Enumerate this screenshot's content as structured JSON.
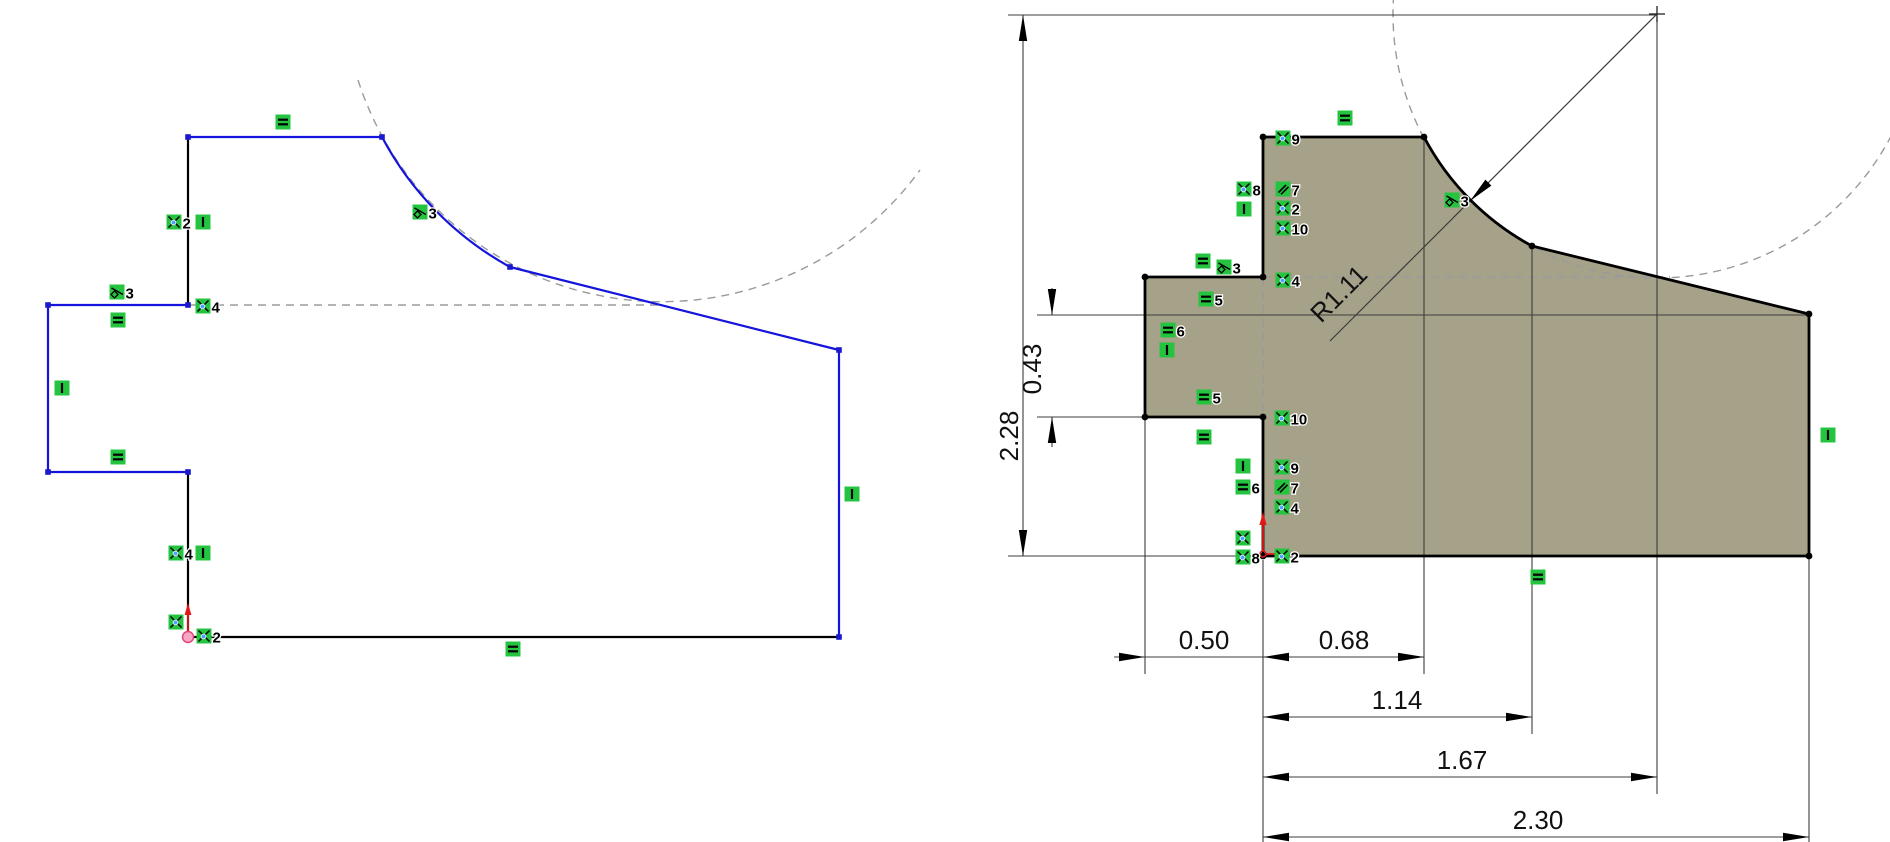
{
  "canvas": {
    "width": 1890,
    "height": 842,
    "background": "#ffffff"
  },
  "palette": {
    "edge_blue": "#1414dd",
    "edge_black": "#000000",
    "part_fill": "#a6a289",
    "relation_green": "#25c440",
    "dash_gray": "#9a9a9a",
    "dim_line": "#3c3c3c",
    "dim_text": "#111111",
    "origin_red": "#e01818",
    "origin_pink": "#f5a7c3",
    "vertex_blue": "#1a1acc",
    "vertex_black": "#000000",
    "coincident_dot": "#4da2ff"
  },
  "left_sketch": {
    "name": "under-defined-profile",
    "edges": [
      {
        "x1": 188,
        "y1": 137,
        "x2": 382,
        "y2": 137,
        "color": "blue"
      },
      {
        "type": "arc",
        "d": "M382 137 A319 319 0 0 0 510 267",
        "color": "blue"
      },
      {
        "x1": 510,
        "y1": 267,
        "x2": 839,
        "y2": 350,
        "color": "blue"
      },
      {
        "x1": 839,
        "y1": 350,
        "x2": 839,
        "y2": 637,
        "color": "blue"
      },
      {
        "x1": 839,
        "y1": 637,
        "x2": 188,
        "y2": 637,
        "color": "black"
      },
      {
        "x1": 188,
        "y1": 637,
        "x2": 188,
        "y2": 472,
        "color": "black"
      },
      {
        "x1": 188,
        "y1": 472,
        "x2": 48,
        "y2": 472,
        "color": "blue"
      },
      {
        "x1": 48,
        "y1": 472,
        "x2": 48,
        "y2": 305,
        "color": "blue"
      },
      {
        "x1": 48,
        "y1": 305,
        "x2": 188,
        "y2": 305,
        "color": "blue"
      },
      {
        "x1": 188,
        "y1": 305,
        "x2": 188,
        "y2": 137,
        "color": "black"
      }
    ],
    "construction": [
      {
        "type": "line",
        "x1": 188,
        "y1": 305,
        "x2": 663,
        "y2": 305
      },
      {
        "type": "path",
        "d": "M358 80 A319 319 0 0 0 920 170"
      }
    ],
    "vertices": [
      [
        188,
        137
      ],
      [
        382,
        137
      ],
      [
        510,
        267
      ],
      [
        839,
        350
      ],
      [
        839,
        637
      ],
      [
        188,
        472
      ],
      [
        48,
        472
      ],
      [
        48,
        305
      ],
      [
        188,
        305
      ]
    ],
    "relations": [
      {
        "type": "equal",
        "x": 283,
        "y": 122
      },
      {
        "type": "coincident",
        "x": 174,
        "y": 222,
        "num": "2"
      },
      {
        "type": "vertical",
        "x": 203,
        "y": 222
      },
      {
        "type": "tangent",
        "x": 420,
        "y": 212,
        "num": "3"
      },
      {
        "type": "tangent",
        "x": 117,
        "y": 292,
        "num": "3"
      },
      {
        "type": "coincident",
        "x": 203,
        "y": 306,
        "num": "4"
      },
      {
        "type": "equal",
        "x": 118,
        "y": 320
      },
      {
        "type": "vertical",
        "x": 62,
        "y": 388
      },
      {
        "type": "equal",
        "x": 118,
        "y": 457
      },
      {
        "type": "coincident",
        "x": 176,
        "y": 553,
        "num": "4"
      },
      {
        "type": "vertical",
        "x": 203,
        "y": 553
      },
      {
        "type": "coincident",
        "x": 176,
        "y": 622
      },
      {
        "type": "coincident",
        "x": 204,
        "y": 636,
        "num": "2"
      },
      {
        "type": "equal",
        "x": 513,
        "y": 649
      },
      {
        "type": "vertical",
        "x": 852,
        "y": 494
      }
    ],
    "origin": {
      "x": 188,
      "y": 637
    }
  },
  "right_sketch": {
    "name": "dimensioned-profile",
    "outline_path": "M1263 556 L1263 417 L1145 417 L1145 277 L1263 277 L1263 137 L1424 137 A264 264 0 0 0 1532 246 L1809 314 L1809 556 Z",
    "edges": [
      {
        "x1": 1263,
        "y1": 556,
        "x2": 1263,
        "y2": 417,
        "color": "black"
      },
      {
        "x1": 1263,
        "y1": 417,
        "x2": 1145,
        "y2": 417,
        "color": "black"
      },
      {
        "x1": 1145,
        "y1": 417,
        "x2": 1145,
        "y2": 277,
        "color": "black"
      },
      {
        "x1": 1145,
        "y1": 277,
        "x2": 1263,
        "y2": 277,
        "color": "black"
      },
      {
        "x1": 1263,
        "y1": 277,
        "x2": 1263,
        "y2": 137,
        "color": "black"
      },
      {
        "x1": 1263,
        "y1": 137,
        "x2": 1424,
        "y2": 137,
        "color": "black"
      },
      {
        "type": "arc",
        "d": "M1424 137 A264 264 0 0 0 1532 246",
        "color": "black"
      },
      {
        "x1": 1532,
        "y1": 246,
        "x2": 1809,
        "y2": 314,
        "color": "black"
      },
      {
        "x1": 1809,
        "y1": 314,
        "x2": 1809,
        "y2": 556,
        "color": "black"
      },
      {
        "x1": 1809,
        "y1": 556,
        "x2": 1263,
        "y2": 556,
        "color": "black"
      }
    ],
    "construction": [
      {
        "type": "circle",
        "cx": 1657,
        "cy": 14,
        "r": 264
      },
      {
        "type": "line",
        "x1": 1263,
        "y1": 277,
        "x2": 1670,
        "y2": 277
      },
      {
        "type": "line",
        "x1": 1263,
        "y1": 277,
        "x2": 1263,
        "y2": 417
      }
    ],
    "vertices": [
      [
        1263,
        556
      ],
      [
        1263,
        417
      ],
      [
        1145,
        417
      ],
      [
        1145,
        277
      ],
      [
        1263,
        277
      ],
      [
        1263,
        137
      ],
      [
        1424,
        137
      ],
      [
        1532,
        246
      ],
      [
        1809,
        314
      ],
      [
        1809,
        556
      ]
    ],
    "relations": [
      {
        "type": "equal",
        "x": 1345,
        "y": 118
      },
      {
        "type": "coincident",
        "x": 1283,
        "y": 138,
        "num": "9"
      },
      {
        "type": "coincident",
        "x": 1244,
        "y": 189,
        "num": "8"
      },
      {
        "type": "vertical",
        "x": 1244,
        "y": 209
      },
      {
        "type": "parallel",
        "x": 1283,
        "y": 189,
        "num": "7"
      },
      {
        "type": "coincident",
        "x": 1283,
        "y": 208,
        "num": "2"
      },
      {
        "type": "coincident",
        "x": 1283,
        "y": 228,
        "num": "10"
      },
      {
        "type": "equal",
        "x": 1203,
        "y": 261
      },
      {
        "type": "tangent",
        "x": 1224,
        "y": 267,
        "num": "3"
      },
      {
        "type": "equal",
        "x": 1206,
        "y": 299,
        "num": "5"
      },
      {
        "type": "coincident",
        "x": 1283,
        "y": 280,
        "num": "4"
      },
      {
        "type": "equal",
        "x": 1168,
        "y": 330,
        "num": "6"
      },
      {
        "type": "vertical",
        "x": 1167,
        "y": 350
      },
      {
        "type": "equal",
        "x": 1204,
        "y": 397,
        "num": "5"
      },
      {
        "type": "coincident",
        "x": 1282,
        "y": 418,
        "num": "10"
      },
      {
        "type": "equal",
        "x": 1204,
        "y": 437
      },
      {
        "type": "vertical",
        "x": 1243,
        "y": 466
      },
      {
        "type": "equal",
        "x": 1243,
        "y": 487,
        "num": "6"
      },
      {
        "type": "coincident",
        "x": 1282,
        "y": 467,
        "num": "9"
      },
      {
        "type": "parallel",
        "x": 1282,
        "y": 487,
        "num": "7"
      },
      {
        "type": "coincident",
        "x": 1282,
        "y": 507,
        "num": "4"
      },
      {
        "type": "coincident",
        "x": 1243,
        "y": 538
      },
      {
        "type": "coincident",
        "x": 1243,
        "y": 557,
        "num": "8"
      },
      {
        "type": "coincident",
        "x": 1282,
        "y": 556,
        "num": "2"
      },
      {
        "type": "tangent",
        "x": 1452,
        "y": 200,
        "num": "3"
      },
      {
        "type": "equal",
        "x": 1538,
        "y": 577
      },
      {
        "type": "vertical",
        "x": 1828,
        "y": 435
      }
    ],
    "origin": {
      "x": 1263,
      "y": 554
    },
    "center_mark": {
      "x": 1657,
      "y": 14
    },
    "dimensions": {
      "extension_lines": [
        [
          1008,
          15,
          1657,
          15
        ],
        [
          1008,
          556,
          1263,
          556
        ],
        [
          1037,
          315,
          1809,
          315
        ],
        [
          1037,
          417,
          1145,
          417
        ],
        [
          1145,
          420,
          1145,
          674
        ],
        [
          1263,
          560,
          1263,
          845
        ],
        [
          1424,
          140,
          1424,
          674
        ],
        [
          1532,
          249,
          1532,
          734
        ],
        [
          1657,
          17,
          1657,
          794
        ],
        [
          1809,
          559,
          1809,
          842
        ]
      ],
      "linear": [
        {
          "label": "2.28",
          "x1": 1023,
          "y1": 15,
          "x2": 1023,
          "y2": 556,
          "arrows": "inside",
          "tx": 1018,
          "ty": 436,
          "rot": -90
        },
        {
          "label": "0.43",
          "segments": [
            [
              1052,
              288,
              1052,
              315
            ],
            [
              1052,
              417,
              1052,
              447
            ]
          ],
          "arrow_tips": [
            [
              1052,
              315,
              90
            ],
            [
              1052,
              417,
              -90
            ]
          ],
          "tx": 1041,
          "ty": 369,
          "rot": -90
        },
        {
          "label": "0.50",
          "x1": 1114,
          "y1": 657,
          "x2": 1263,
          "y2": 657,
          "arrow_tips": [
            [
              1145,
              657,
              0
            ]
          ],
          "tx": 1204,
          "ty": 649,
          "rot": 0
        },
        {
          "label": "0.68",
          "x1": 1263,
          "y1": 657,
          "x2": 1424,
          "y2": 657,
          "arrows": "inside",
          "tx": 1344,
          "ty": 649,
          "rot": 0
        },
        {
          "label": "1.14",
          "x1": 1263,
          "y1": 717,
          "x2": 1532,
          "y2": 717,
          "arrows": "inside",
          "tx": 1397,
          "ty": 709,
          "rot": 0
        },
        {
          "label": "1.67",
          "x1": 1263,
          "y1": 777,
          "x2": 1657,
          "y2": 777,
          "arrows": "inside",
          "tx": 1462,
          "ty": 769,
          "rot": 0
        },
        {
          "label": "2.30",
          "x1": 1263,
          "y1": 837,
          "x2": 1809,
          "y2": 837,
          "arrows": "inside",
          "tx": 1538,
          "ty": 829,
          "rot": 0
        }
      ],
      "radial": {
        "label": "R1.11",
        "x1": 1657,
        "y1": 14,
        "x2": 1330,
        "y2": 341,
        "arrow_tip": [
          1470,
          201,
          135
        ],
        "tx": 1345,
        "ty": 300,
        "rot": -45
      }
    }
  }
}
